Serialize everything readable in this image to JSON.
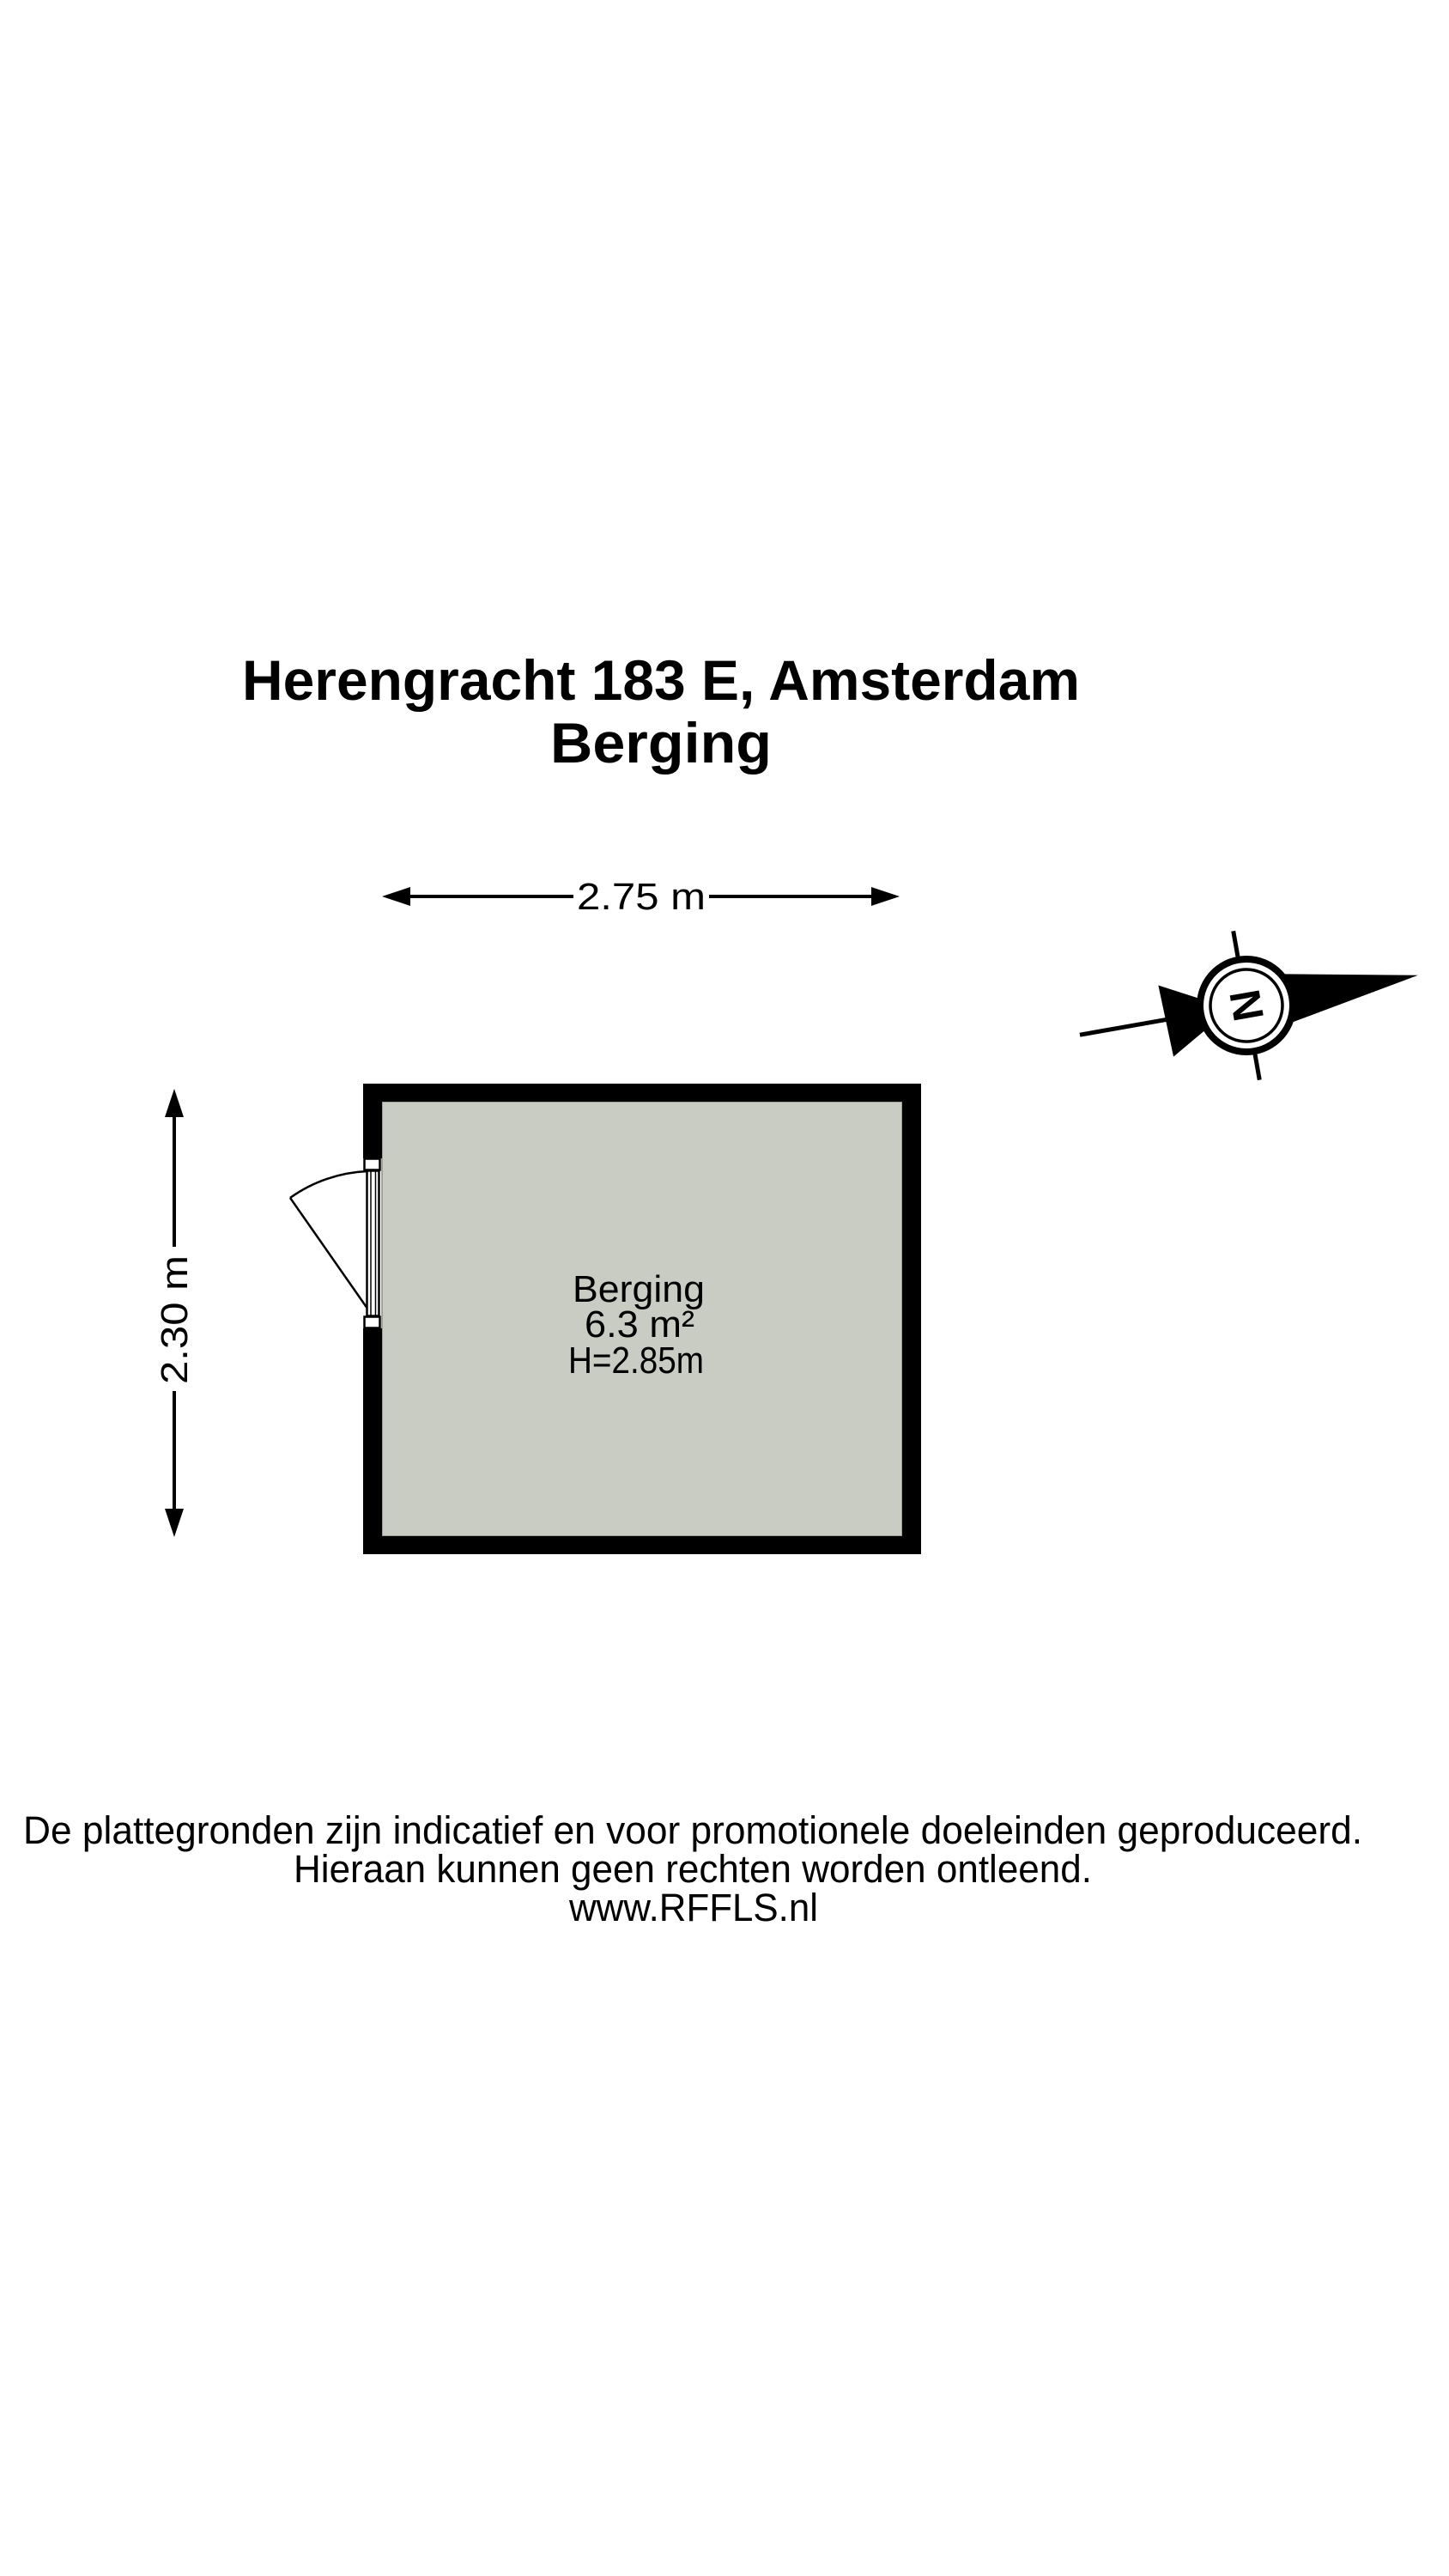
{
  "title": {
    "line1": "Herengracht 183 E, Amsterdam",
    "line2": "Berging"
  },
  "floorplan": {
    "room": {
      "name": "Berging",
      "area": "6.3 m²",
      "ceiling_height": "H=2.85m"
    },
    "dimensions": {
      "width_label": "2.75 m",
      "height_label": "2.30 m"
    },
    "compass": {
      "letter": "N"
    }
  },
  "footer": {
    "line1": "De plattegronden zijn indicatief en voor promotionele doeleinden geproduceerd.",
    "line2": "Hieraan kunnen geen rechten worden ontleend.",
    "line3": "www.RFFLS.nl"
  },
  "colors": {
    "floor_fill": "#c9ccc3",
    "floor_edge": "#8b8f85",
    "wall": "#000000",
    "background": "#ffffff"
  }
}
